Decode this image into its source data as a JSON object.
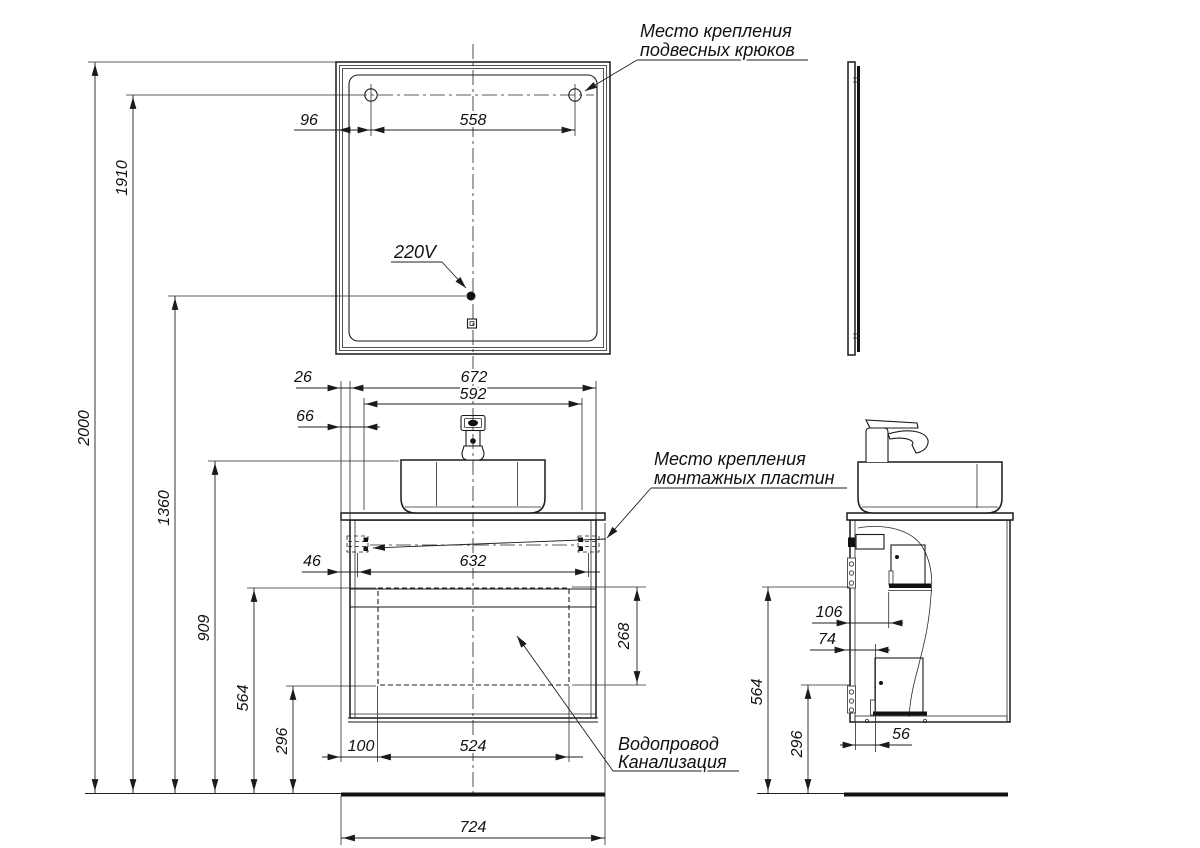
{
  "callouts": {
    "hooks": {
      "line1": "Место крепления",
      "line2": "подвесных крюков"
    },
    "power": {
      "label": "220V"
    },
    "plates": {
      "line1": "Место крепления",
      "line2": "монтажных пластин"
    },
    "plumbing": {
      "line1": "Водопровод",
      "line2": "Канализация"
    }
  },
  "dims": {
    "mirror": {
      "hook_offset": "96",
      "hook_spacing": "558"
    },
    "heights": {
      "overall": "2000",
      "hooks": "1910",
      "outlet": "1360",
      "basin_rim": "909",
      "opening_top": "564",
      "opening_bottom": "296"
    },
    "front": {
      "overhang": "26",
      "cabinet_width": "672",
      "inner_span": "592",
      "inner_offset": "66",
      "plate_offset": "46",
      "plate_spacing": "632",
      "opening_height": "268",
      "opening_offset": "100",
      "opening_width": "524",
      "overall_width": "724"
    },
    "side": {
      "upper_plate": "106",
      "lower_plate": "74",
      "bottom_plate": "56",
      "opening_top": "564",
      "opening_bottom": "296"
    }
  }
}
